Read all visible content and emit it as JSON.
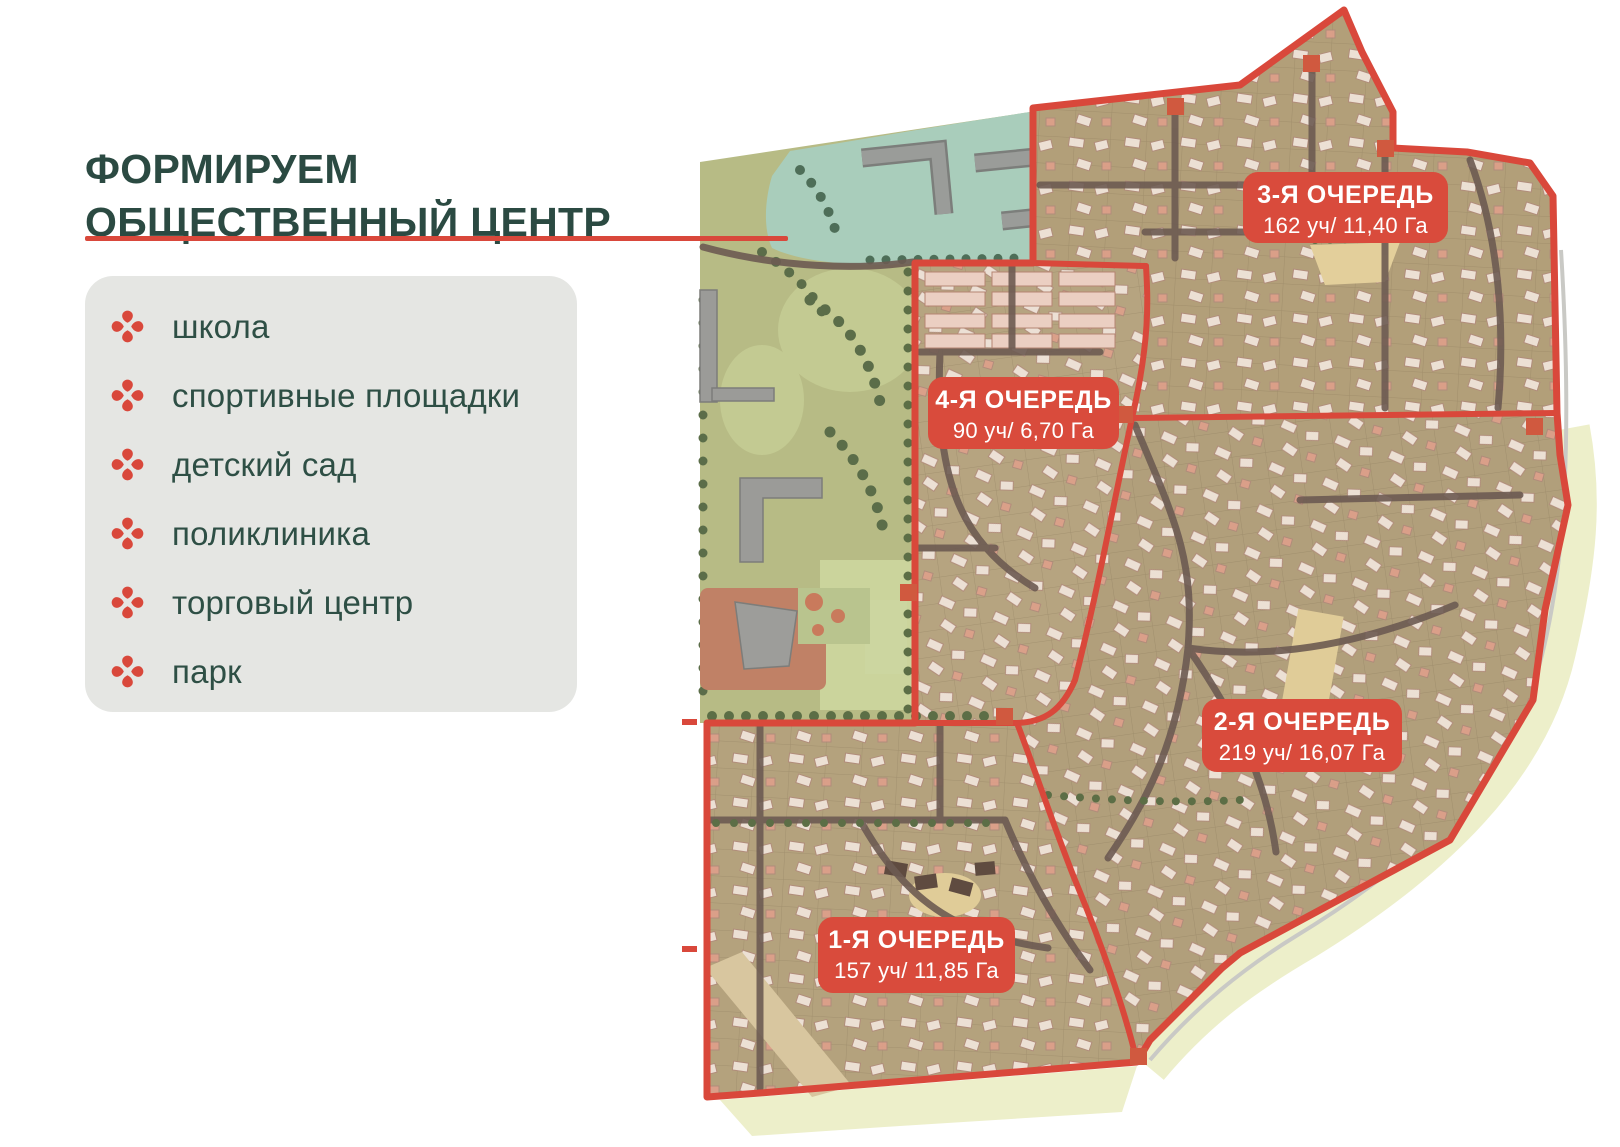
{
  "header": {
    "title_line1": "ФОРМИРУЕМ",
    "title_line2": "ОБЩЕСТВЕННЫЙ ЦЕНТР"
  },
  "amenities": {
    "items": [
      "школа",
      "спортивные площадки",
      "детский сад",
      "поликлиника",
      "торговый центр",
      "парк"
    ]
  },
  "phases": {
    "p1": {
      "name": "1-Я ОЧЕРЕДЬ",
      "stats": "157 уч/ 11,85 Га"
    },
    "p2": {
      "name": "2-Я ОЧЕРЕДЬ",
      "stats": "219 уч/ 16,07 Га"
    },
    "p3": {
      "name": "3-Я ОЧЕРЕДЬ",
      "stats": "162 уч/ 11,40 Га"
    },
    "p4": {
      "name": "4-Я ОЧЕРЕДЬ",
      "stats": "90 уч/ 6,70 Га"
    }
  },
  "colors": {
    "accent_red": "#d9483b",
    "label_red": "#d94b3c",
    "title_green": "#2b4a42",
    "panel_gray": "#e5e6e3",
    "parcel_tan": "#b3a17c",
    "park_olive": "#b7bb85",
    "school_teal": "#a9cdbb",
    "sand": "#edefca"
  }
}
